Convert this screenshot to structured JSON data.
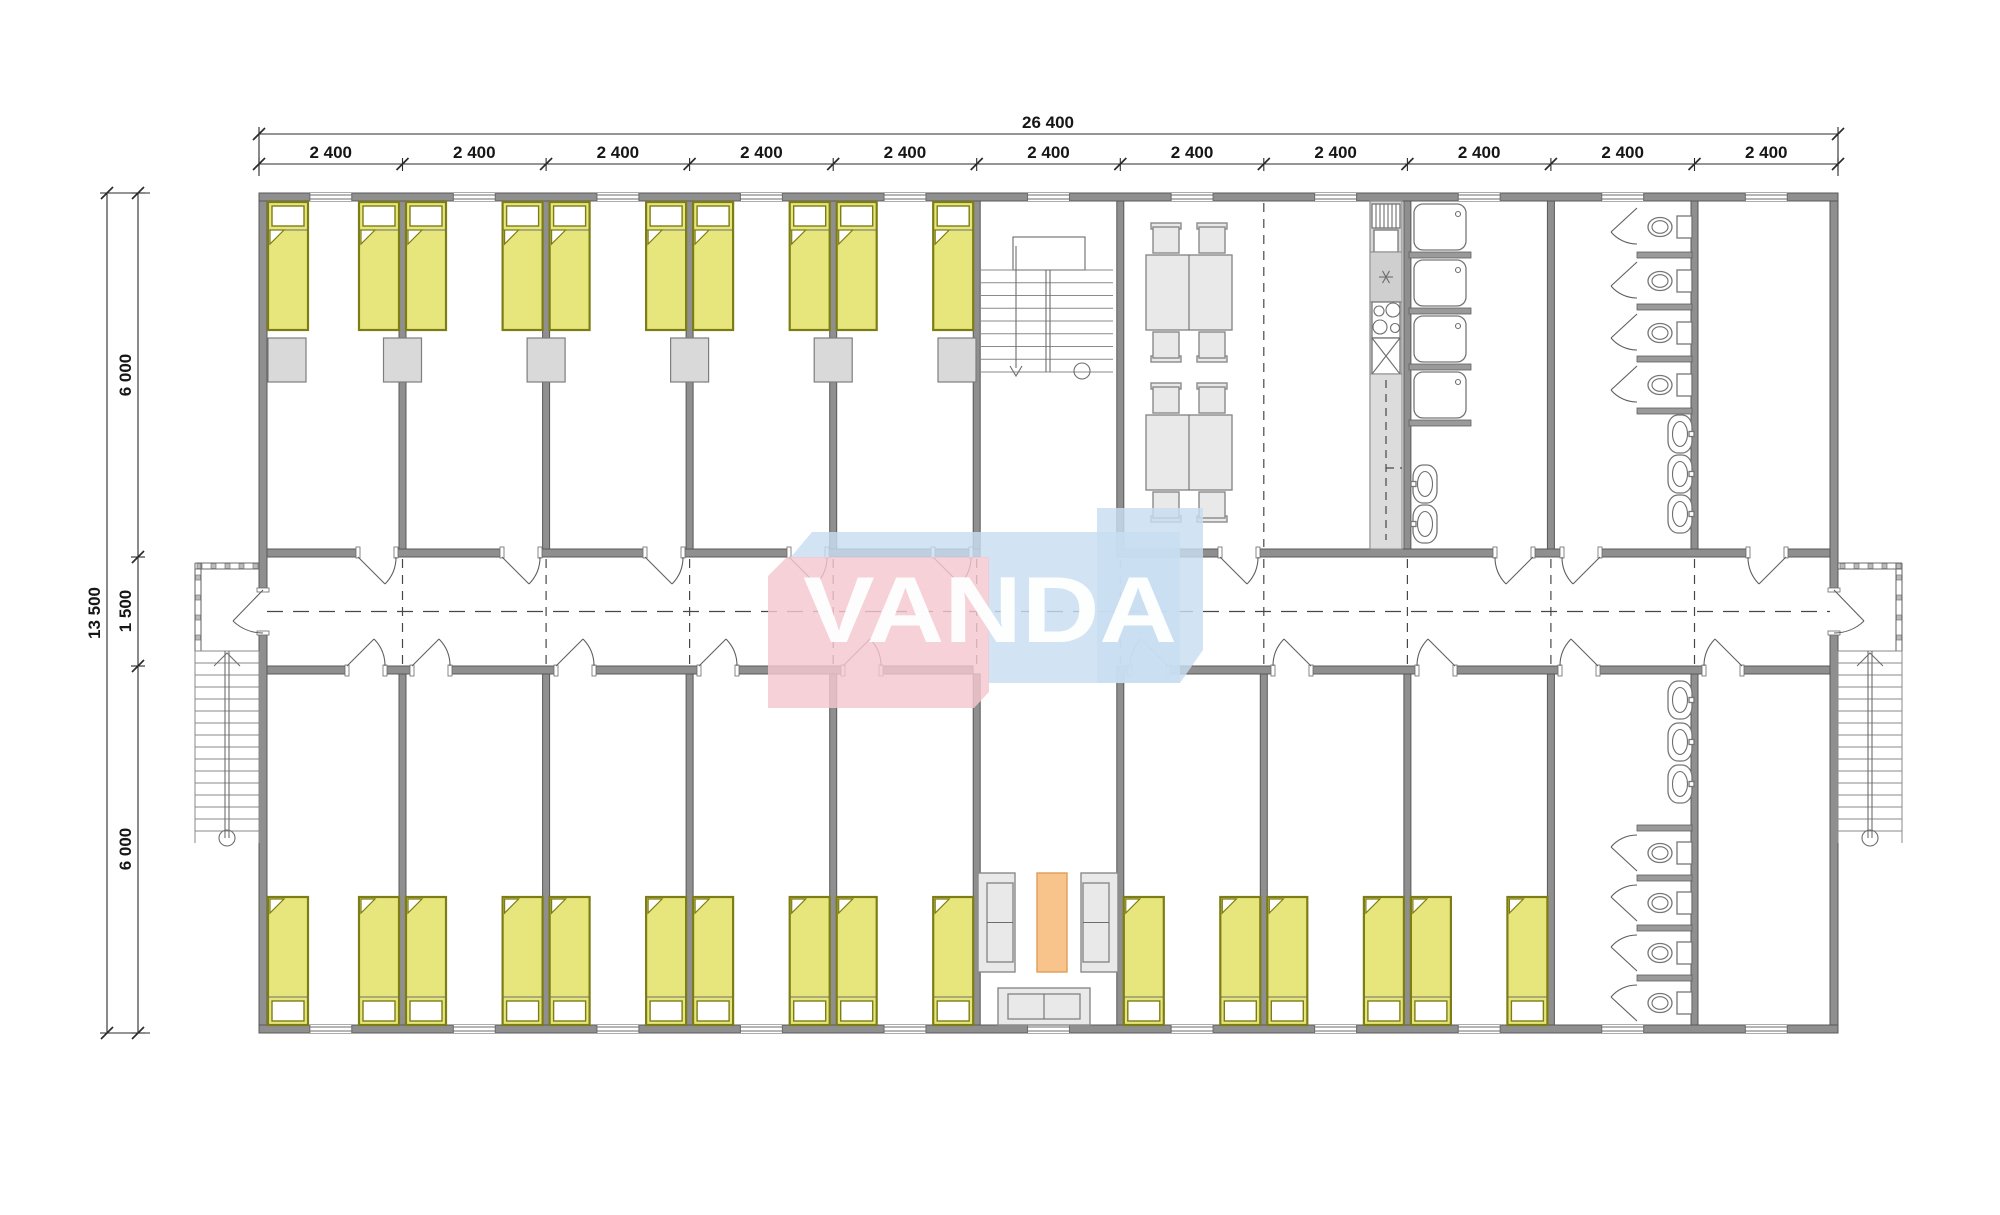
{
  "watermark": {
    "text": "VANDA",
    "pink": "#f5c7cf",
    "blue": "#c8def2",
    "text_color": "#ffffff",
    "shape_blue_main": "M790,558 L812,532 L1180,532 L1180,683 L988,683 L988,558 Z",
    "shape_blue_tip": "M1097,508 L1203,508 L1203,650 L1180,683 L1097,683 Z",
    "shape_pink": "M768,576 L787,557 L989,557 L989,692 L974,708 L768,708 Z",
    "text_x": 803,
    "text_y": 642,
    "text_length": 374,
    "font_size": 94
  },
  "dimensions": {
    "top_total": {
      "label": "26 400",
      "y": 134,
      "x1": 259,
      "x2": 1838,
      "label_x": 1048,
      "label_y": 128
    },
    "top_modules": {
      "label": "2 400",
      "y": 164,
      "label_y": 158,
      "ticks": [
        259,
        402.5,
        546.1,
        689.6,
        833.2,
        976.7,
        1120.3,
        1263.8,
        1407.4,
        1550.9,
        1694.5,
        1838
      ]
    },
    "left_total": {
      "label": "13 500",
      "x": 107,
      "y1": 193,
      "y2": 1033,
      "label_x": 100,
      "label_y": 613
    },
    "left_modules": {
      "labels": [
        "6 000",
        "1 500",
        "6 000"
      ],
      "x": 138,
      "ticks": [
        193,
        557,
        666,
        1033
      ],
      "label_x": 131,
      "label_ys": [
        375,
        611,
        849
      ]
    }
  },
  "plan": {
    "wall_rects": [
      [
        259,
        193,
        1579,
        8
      ],
      [
        259,
        1025,
        1579,
        8
      ],
      [
        259,
        201,
        8,
        389
      ],
      [
        259,
        633,
        8,
        392
      ],
      [
        1830,
        201,
        8,
        389
      ],
      [
        1830,
        633,
        8,
        392
      ],
      [
        399,
        201,
        7,
        348
      ],
      [
        542.6,
        201,
        7,
        348
      ],
      [
        686.1,
        201,
        7,
        348
      ],
      [
        829.7,
        201,
        7,
        348
      ],
      [
        973.2,
        201,
        7,
        348
      ],
      [
        1116.8,
        201,
        7,
        348
      ],
      [
        1403.9,
        201,
        7,
        348
      ],
      [
        1547.4,
        201,
        7,
        348
      ],
      [
        1691,
        201,
        7,
        348
      ],
      [
        399,
        674,
        7,
        351
      ],
      [
        542.6,
        674,
        7,
        351
      ],
      [
        686.1,
        674,
        7,
        351
      ],
      [
        829.7,
        674,
        7,
        351
      ],
      [
        973.2,
        674,
        7,
        351
      ],
      [
        1116.8,
        674,
        7,
        351
      ],
      [
        1260.3,
        674,
        7,
        351
      ],
      [
        1403.9,
        674,
        7,
        351
      ],
      [
        1547.4,
        674,
        7,
        351
      ],
      [
        1691,
        674,
        7,
        351
      ]
    ],
    "corridor_top_y": 549,
    "corridor_bottom_y": 666,
    "corridor_top_segments": [
      [
        267,
        358
      ],
      [
        396,
        502
      ],
      [
        540,
        645
      ],
      [
        683,
        789
      ],
      [
        827,
        980
      ],
      [
        1116.8,
        1220
      ],
      [
        1258,
        1495
      ],
      [
        1533,
        1562
      ],
      [
        1600,
        1748
      ],
      [
        1786,
        1830
      ]
    ],
    "corridor_bottom_segments": [
      [
        267,
        347
      ],
      [
        385,
        412
      ],
      [
        450,
        556
      ],
      [
        594,
        699
      ],
      [
        737,
        843
      ],
      [
        881,
        973
      ],
      [
        1116.8,
        1130
      ],
      [
        1168,
        1273
      ],
      [
        1311,
        1417
      ],
      [
        1455,
        1560
      ],
      [
        1598,
        1704
      ],
      [
        1742,
        1830
      ]
    ],
    "stub_rects": [
      [
        1409,
        252,
        62,
        6
      ],
      [
        1409,
        308,
        62,
        6
      ],
      [
        1409,
        364,
        62,
        6
      ],
      [
        1409,
        420,
        62,
        6
      ],
      [
        1637,
        252,
        55,
        6
      ],
      [
        1637,
        304,
        55,
        6
      ],
      [
        1637,
        356,
        55,
        6
      ],
      [
        1637,
        408,
        55,
        6
      ],
      [
        1637,
        825,
        55,
        6
      ],
      [
        1637,
        875,
        55,
        6
      ],
      [
        1637,
        925,
        55,
        6
      ],
      [
        1637,
        975,
        55,
        6
      ]
    ],
    "doors_top": [
      {
        "x1": 358,
        "x2": 396,
        "hinge": "left"
      },
      {
        "x1": 502,
        "x2": 540,
        "hinge": "left"
      },
      {
        "x1": 645,
        "x2": 683,
        "hinge": "left"
      },
      {
        "x1": 789,
        "x2": 827,
        "hinge": "left"
      },
      {
        "x1": 933,
        "x2": 971,
        "hinge": "left"
      },
      {
        "x1": 1220,
        "x2": 1258,
        "hinge": "left"
      },
      {
        "x1": 1495,
        "x2": 1533,
        "hinge": "right"
      },
      {
        "x1": 1562,
        "x2": 1600,
        "hinge": "right"
      },
      {
        "x1": 1748,
        "x2": 1786,
        "hinge": "right"
      }
    ],
    "doors_bottom": [
      {
        "x1": 347,
        "x2": 385,
        "hinge": "left"
      },
      {
        "x1": 412,
        "x2": 450,
        "hinge": "left"
      },
      {
        "x1": 556,
        "x2": 594,
        "hinge": "left"
      },
      {
        "x1": 699,
        "x2": 737,
        "hinge": "left"
      },
      {
        "x1": 843,
        "x2": 881,
        "hinge": "left"
      },
      {
        "x1": 1130,
        "x2": 1168,
        "hinge": "right"
      },
      {
        "x1": 1273,
        "x2": 1311,
        "hinge": "right"
      },
      {
        "x1": 1417,
        "x2": 1455,
        "hinge": "right"
      },
      {
        "x1": 1560,
        "x2": 1598,
        "hinge": "right"
      },
      {
        "x1": 1704,
        "x2": 1742,
        "hinge": "right"
      }
    ],
    "end_doors": [
      {
        "side": "left",
        "gap_y1": 590,
        "gap_y2": 633
      },
      {
        "side": "right",
        "gap_y1": 590,
        "gap_y2": 633
      }
    ],
    "windows": {
      "centers": [
        330.8,
        474.3,
        617.9,
        761.4,
        905,
        1048.5,
        1192.1,
        1335.6,
        1479.2,
        1622.7,
        1766.3
      ],
      "half_width": 21,
      "top_y": 193,
      "bottom_y": 1025,
      "wall_t": 8
    },
    "beds": {
      "w": 40,
      "h": 128,
      "fill": "#e6e67c",
      "stroke": "#7d7d15",
      "top_yxs": [
        268,
        359,
        406,
        502.6,
        549.6,
        646.1,
        693.1,
        789.7,
        836.7,
        933.2
      ],
      "top_y": 202,
      "bottom_yxs": [
        268,
        359,
        406,
        502.6,
        549.6,
        646.1,
        693.1,
        789.7,
        836.7,
        933.2,
        1123.8,
        1220.3,
        1267.3,
        1363.9,
        1410.9,
        1507.4
      ],
      "bottom_y": 897
    },
    "lockers": {
      "xs": [
        268,
        383.5,
        527.1,
        670.6,
        814.2,
        938
      ],
      "y": 338,
      "w": 38,
      "h": 44,
      "fill": "#d9d9d9",
      "stroke": "#7e7e7e"
    },
    "dashed": {
      "center_y": 611.5,
      "center_x1": 267,
      "center_x2": 1830,
      "module_xs": [
        402.5,
        546.1,
        689.6,
        833.2,
        976.7,
        1120.3,
        1263.8,
        1407.4,
        1550.9,
        1694.5
      ],
      "corr_y1": 559,
      "corr_y2": 664,
      "open_partition_x": 1263.8,
      "open_y1": 203,
      "open_y2": 547
    },
    "stair_bay": {
      "landing": [
        1013,
        237,
        72,
        33
      ],
      "tread_x1": 981,
      "tread_x2": 1113,
      "tread_y0": 270,
      "tread_dy": 12.75,
      "tread_n": 9,
      "rail_x": 1048,
      "rail_y1": 270,
      "rail_y2": 372,
      "arrow_x": 1016,
      "arrow_y1": 246,
      "arrow_y2": 368,
      "circle": [
        1082,
        371,
        8
      ]
    },
    "dining": {
      "tables": [
        [
          1146,
          255
        ],
        [
          1146,
          415
        ]
      ],
      "tw": 86,
      "th": 75,
      "chair_cxs": [
        1166,
        1212
      ],
      "chair_w": 26,
      "chair_h": 24
    },
    "kitchen": {
      "strip": [
        1370,
        201,
        32,
        348
      ],
      "grille": [
        1372,
        204,
        28,
        24
      ],
      "box": [
        1374,
        230,
        24,
        22
      ],
      "ast_block": [
        1370,
        252,
        32,
        50
      ],
      "ast_c": [
        1386,
        277
      ],
      "hob": [
        1372,
        302,
        28,
        36
      ],
      "hob_circles": [
        [
          1379,
          311,
          5
        ],
        [
          1393,
          310,
          7
        ],
        [
          1380,
          327,
          7
        ],
        [
          1395,
          328,
          4.5
        ]
      ],
      "xbox": [
        1372,
        338,
        28,
        36
      ],
      "counter": [
        1370,
        374,
        32,
        175
      ],
      "dash_x": 1386,
      "dash_y1": 380,
      "dash_y2": 540,
      "notch_y": 468
    },
    "showers": {
      "x": 1414,
      "w": 52,
      "h": 46,
      "ys": [
        204,
        260,
        316,
        372
      ],
      "drain_dx": 44,
      "drain_dy": 10
    },
    "toilets": {
      "top_cys": [
        227,
        281,
        333,
        385
      ],
      "bottom_cys": [
        853,
        903,
        953,
        1003
      ],
      "tank_x": 1677,
      "bowl_cx": 1660
    },
    "stall_doors": {
      "top_y1s": [
        204,
        258,
        310,
        362
      ],
      "bottom_y2s": [
        875,
        925,
        975,
        1025
      ],
      "x": 1637
    },
    "basins": {
      "right_wall_top_cys": [
        434,
        474,
        514
      ],
      "right_wall_bottom_cys": [
        700,
        742,
        784
      ],
      "left_wall_cys": [
        484,
        524
      ],
      "right_x": 1668,
      "left_x": 1413,
      "w": 24,
      "h": 38
    },
    "lounge": {
      "sofa_left": [
        978,
        873,
        37,
        99
      ],
      "sofa_right": [
        1081,
        873,
        37,
        99
      ],
      "rug": [
        1037,
        873,
        30,
        99
      ],
      "rug_fill": "#f8c48c",
      "rug_stroke": "#dd9f58",
      "sofa_bottom": [
        998,
        988,
        92,
        37
      ]
    },
    "porches": [
      {
        "side": "left",
        "x1": 195,
        "x2": 259,
        "rail_y": 563,
        "y2": 651
      },
      {
        "side": "right",
        "x1": 1838,
        "x2": 1902,
        "rail_y": 563,
        "y2": 651
      }
    ],
    "ext_stairs": [
      {
        "x1": 195,
        "x2": 259,
        "y0": 651,
        "dy": 12,
        "n": 16,
        "rail_x": 227,
        "circle": [
          227,
          838,
          8
        ]
      },
      {
        "x1": 1838,
        "x2": 1902,
        "y0": 651,
        "dy": 12,
        "n": 16,
        "rail_x": 1870,
        "circle": [
          1870,
          838,
          8
        ]
      }
    ]
  }
}
